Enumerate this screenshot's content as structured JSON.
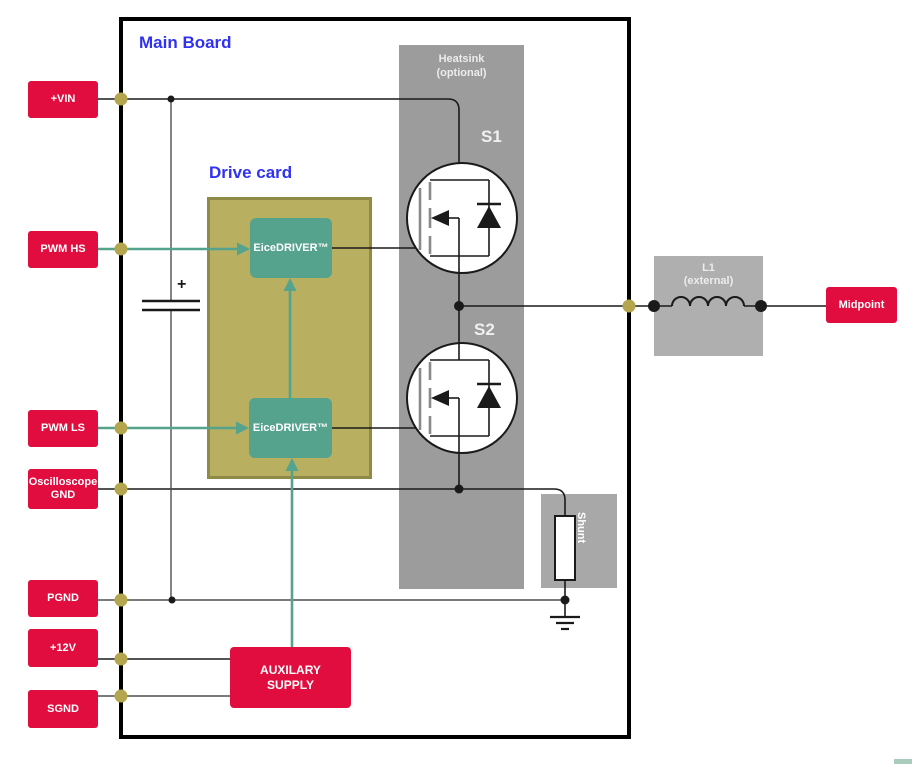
{
  "blocks": {
    "main_board": "Main Board",
    "drive_card": "Drive card",
    "heatsink": "Heatsink\n(optional)",
    "switch_s1": "S1",
    "switch_s2": "S2",
    "driver_hs": "EiceDRIVER™",
    "driver_ls": "EiceDRIVER™",
    "shunt": "Shunt",
    "inductor": "L1\n(external)",
    "aux_supply": "AUXILARY\nSUPPLY",
    "capacitor_polarity": "+"
  },
  "terminals": [
    {
      "label": "+VIN"
    },
    {
      "label": "PWM HS"
    },
    {
      "label": "PWM LS"
    },
    {
      "label": "Oscilloscope\nGND"
    },
    {
      "label": "PGND"
    },
    {
      "label": "+12V"
    },
    {
      "label": "SGND"
    },
    {
      "label": "Midpoint"
    }
  ],
  "colors": {
    "terminal_red": "#E00D3E",
    "title_blue": "#3032F0",
    "driver_teal": "#55A28D",
    "card_olive_fill": "#B9AF61",
    "card_olive_border": "#8F8A45",
    "heatsink_gray": "#9C9C9C",
    "shunt_gray": "#A8A8A8",
    "inductor_gray": "#AFAFAF",
    "connection_dot_olive": "#B4A64E",
    "wire_black": "#1a1a1a",
    "wire_gray": "#4f4f4f",
    "corner_strip_teal": "#A9CCBC"
  }
}
